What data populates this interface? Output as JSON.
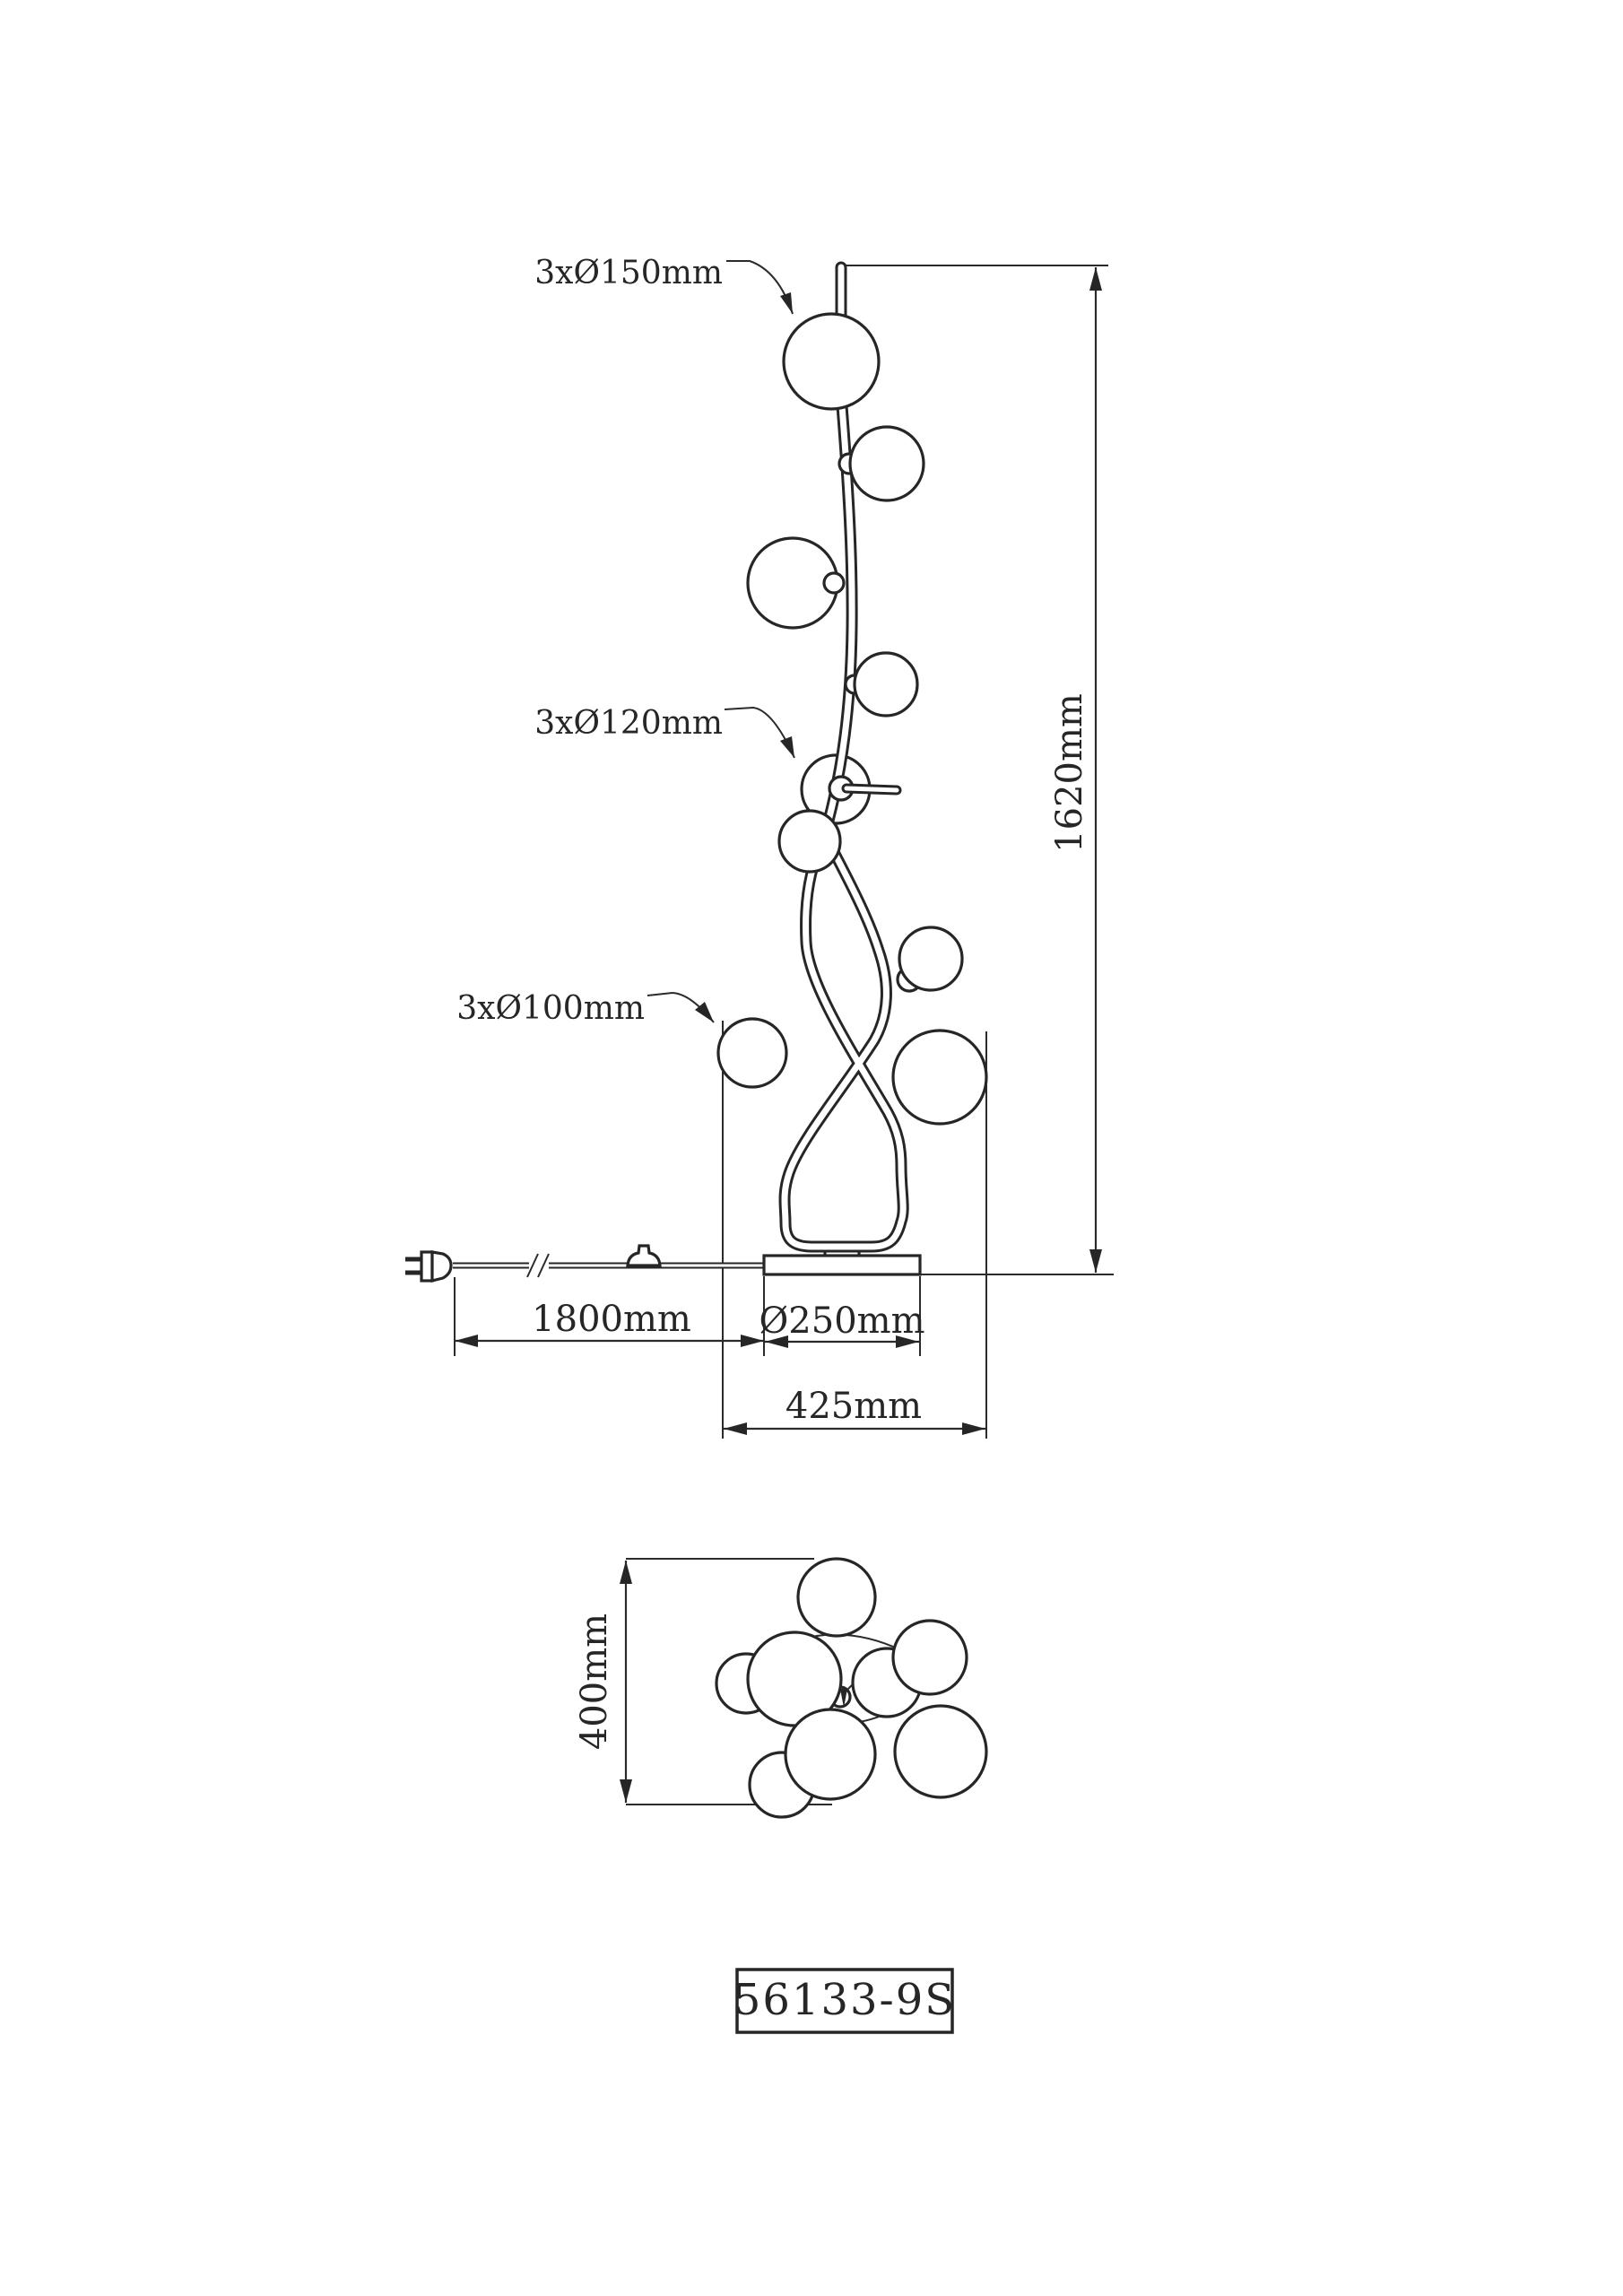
{
  "front_view": {
    "label_150mm": "3xØ150mm",
    "label_120mm": "3xØ120mm",
    "label_100mm": "3xØ100mm",
    "height_dim": "1620mm",
    "cable_dim": "1800mm",
    "base_dim": "Ø250mm",
    "width_dim": "425mm"
  },
  "top_view": {
    "depth_dim": "400mm"
  },
  "model_label": "56133-9S",
  "colors": {
    "line": "#262626",
    "background": "#ffffff"
  }
}
